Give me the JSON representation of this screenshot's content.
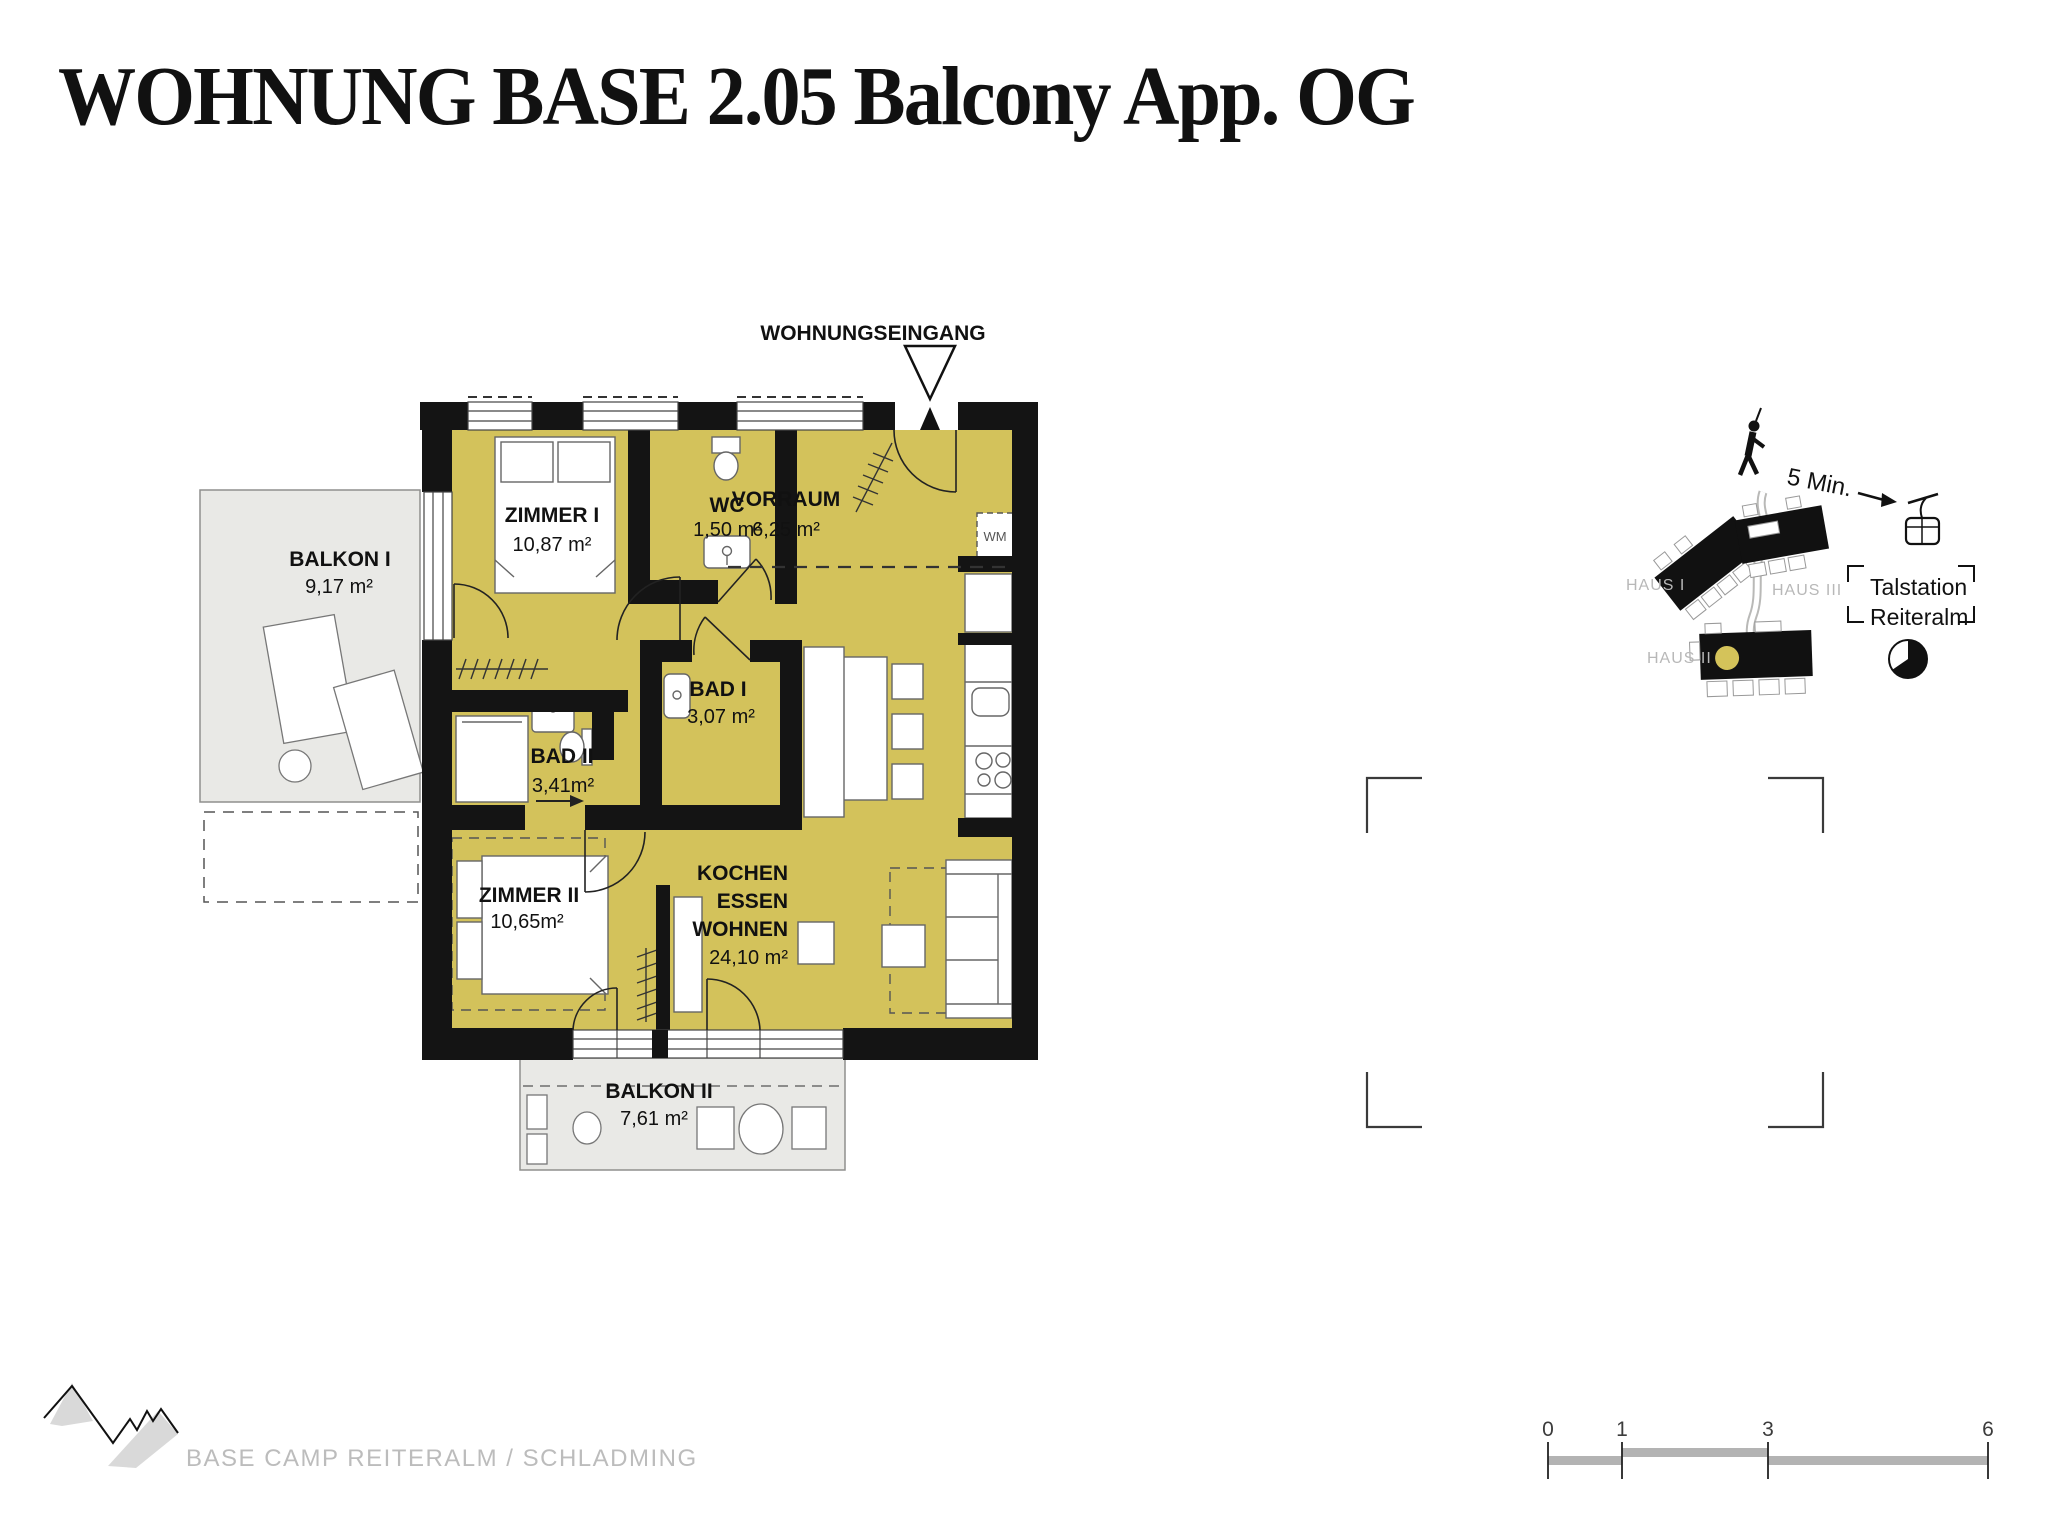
{
  "title": "WOHNUNG BASE 2.05 Balcony App. OG",
  "floor_plan": {
    "entrance_label": "WOHNUNGSEINGANG",
    "rooms": {
      "zimmer1": {
        "name": "ZIMMER I",
        "area": "10,87 m²"
      },
      "wc": {
        "name": "WC",
        "area": "1,50 m²"
      },
      "vorraum": {
        "name": "VORRAUM",
        "area": "6,25 m²"
      },
      "bad1": {
        "name": "BAD I",
        "area": "3,07 m²"
      },
      "bad2": {
        "name": "BAD II",
        "area": "3,41m²"
      },
      "zimmer2": {
        "name": "ZIMMER II",
        "area": "10,65m²"
      },
      "wohnen": {
        "line1": "KOCHEN",
        "line2": "ESSEN",
        "line3": "WOHNEN",
        "area": "24,10 m²"
      },
      "balkon1": {
        "name": "BALKON I",
        "area": "9,17 m²"
      },
      "balkon2": {
        "name": "BALKON II",
        "area": "7,61 m²"
      }
    },
    "washing_machine_label": "WM"
  },
  "site_map": {
    "walk_time": "5 Min.",
    "haus1": "HAUS I",
    "haus3": "HAUS III",
    "haus2": "HAUS II",
    "station_line1": "Talstation",
    "station_line2": "Reiteralm"
  },
  "scale_bar": {
    "t0": "0",
    "t1": "1",
    "t3": "3",
    "t6": "6"
  },
  "footer": {
    "brand": "BASE CAMP REITERALM / SCHLADMING"
  },
  "colors": {
    "room_fill": "#d3c25b",
    "balcony_fill": "#e9e9e6",
    "wall": "#141414",
    "accent_dot": "#d4c35a"
  }
}
